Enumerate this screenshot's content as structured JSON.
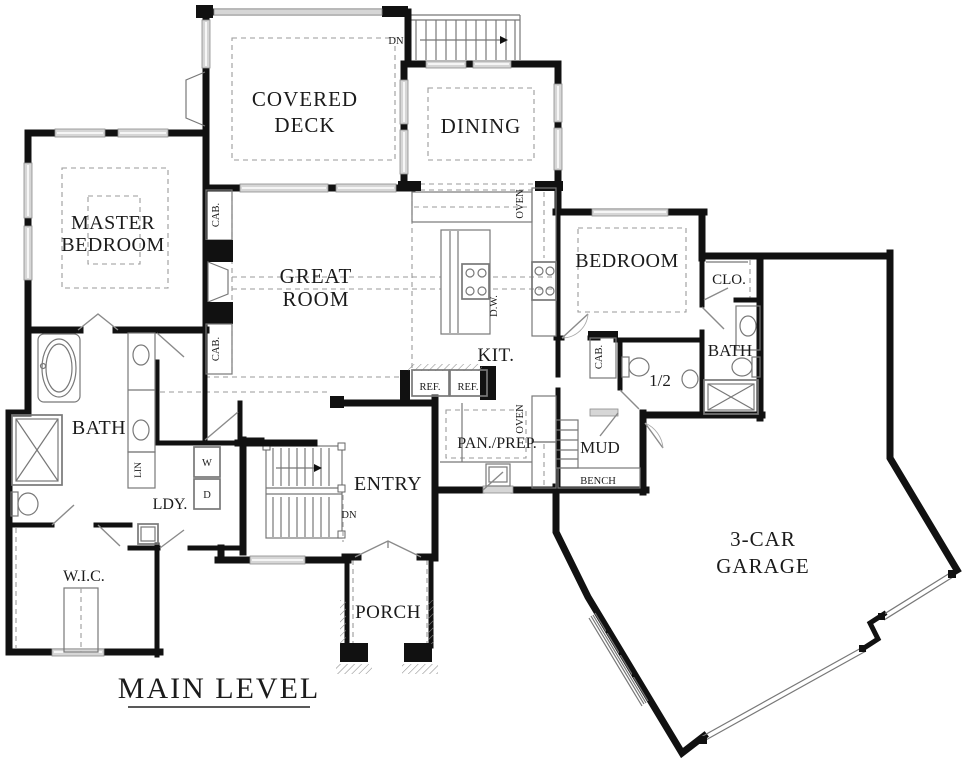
{
  "title": {
    "text": "MAIN LEVEL"
  },
  "rooms": {
    "covered_deck": {
      "line1": "COVERED",
      "line2": "DECK"
    },
    "dining": {
      "label": "DINING"
    },
    "master_bedroom": {
      "line1": "MASTER",
      "line2": "BEDROOM"
    },
    "great_room": {
      "line1": "GREAT",
      "line2": "ROOM"
    },
    "bedroom": {
      "label": "BEDROOM"
    },
    "closet": {
      "label": "CLO."
    },
    "bath_right": {
      "label": "BATH"
    },
    "half_bath": {
      "label": "1/2"
    },
    "kitchen": {
      "label": "KIT."
    },
    "bath_left": {
      "label": "BATH"
    },
    "laundry": {
      "label": "LDY."
    },
    "walk_in_closet": {
      "label": "W.I.C."
    },
    "entry": {
      "label": "ENTRY"
    },
    "pantry_prep": {
      "label": "PAN./PREP."
    },
    "mud": {
      "label": "MUD"
    },
    "bench": {
      "label": "BENCH"
    },
    "porch": {
      "label": "PORCH"
    },
    "garage": {
      "line1": "3-CAR",
      "line2": "GARAGE"
    }
  },
  "annotations": {
    "dn_deck": "DN",
    "dn_entry": "DN",
    "cab": "CAB.",
    "oven": "OVEN",
    "ref": "REF.",
    "dw": "D.W.",
    "lin": "LIN",
    "washer": "W",
    "dryer": "D"
  },
  "colors": {
    "wall": "#111111",
    "line": "#787878",
    "dash": "#9a9a9a",
    "window": "#d6d6d6",
    "background": "#ffffff"
  }
}
